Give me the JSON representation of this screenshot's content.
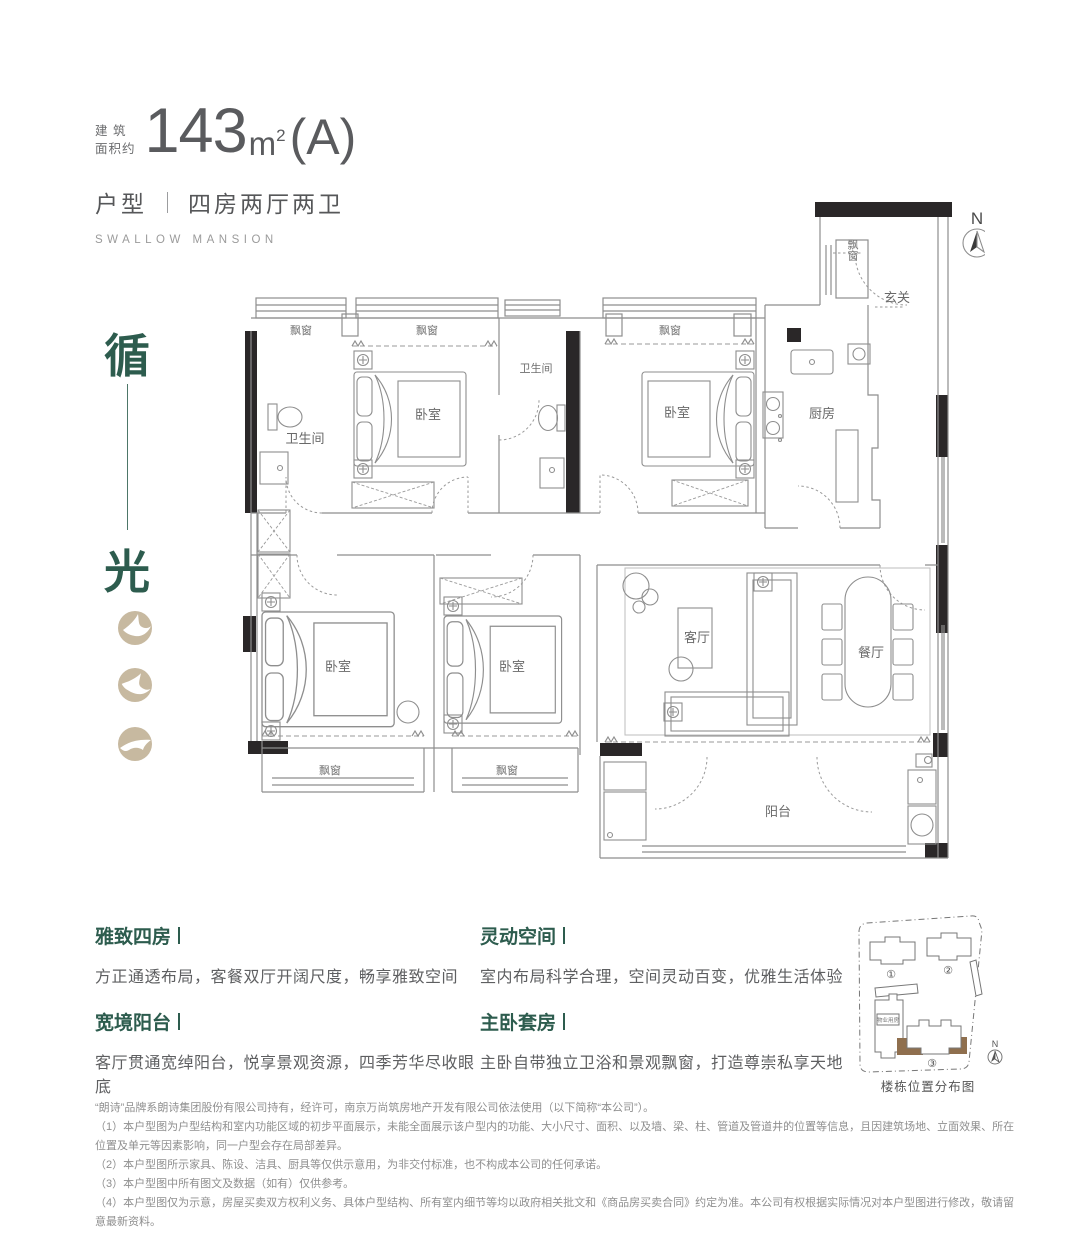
{
  "header": {
    "area_label_line1": "建 筑",
    "area_label_line2": "面积约",
    "area_value": "143",
    "area_unit": "m",
    "area_unit_sup": "2",
    "area_variant": "(A)",
    "type_label": "户型",
    "type_value": "四房两厅两卫",
    "subtitle": "SWALLOW MANSION"
  },
  "side_motto": {
    "top": "循",
    "bottom": "光"
  },
  "compass": {
    "north": "N"
  },
  "floorplan": {
    "rooms": {
      "bay_window": "飘窗",
      "bedroom": "卧室",
      "bathroom": "卫生间",
      "kitchen": "厨房",
      "entry": "玄关",
      "living_room": "客厅",
      "dining_room": "餐厅",
      "balcony": "阳台"
    }
  },
  "features": [
    {
      "title": "雅致四房",
      "desc": "方正通透布局，客餐双厅开阔尺度，畅享雅致空间"
    },
    {
      "title": "宽境阳台",
      "desc": "客厅贯通宽绰阳台，悦享景观资源，四季芳华尽收眼底"
    },
    {
      "title": "灵动空间",
      "desc": "室内布局科学合理，空间灵动百变，优雅生活体验"
    },
    {
      "title": "主卧套房",
      "desc": "主卧自带独立卫浴和景观飘窗，打造尊崇私享天地"
    }
  ],
  "sitemap": {
    "caption": "楼栋位置分布图",
    "buildings": [
      "①",
      "②",
      "③"
    ],
    "property_room_label": "物业用房",
    "north": "N",
    "highlight_color": "#8f6f4e"
  },
  "disclaimer": {
    "lines": [
      "“朗诗”品牌系朗诗集团股份有限公司持有，经许可，南京万尚筑房地产开发有限公司依法使用（以下简称“本公司”）。",
      "（1）本户型图为户型结构和室内功能区域的初步平面展示，未能全面展示该户型内的功能、大小尺寸、面积、以及墙、梁、柱、管道及管道井的位置等信息，且因建筑场地、立面效果、所在位置及单元等因素影响，同一户型会存在局部差异。",
      "（2）本户型图所示家具、陈设、洁具、厨具等仅供示意用，为非交付标准，也不构成本公司的任何承诺。",
      "（3）本户型图中所有图文及数据（如有）仅供参考。",
      "（4）本户型图仅为示意，房屋买卖双方权利义务、具体户型结构、所有室内细节等均以政府相关批文和《商品房买卖合同》约定为准。本公司有权根据实际情况对本户型图进行修改，敬请留意最新资料。"
    ]
  },
  "colors": {
    "accent_green": "#2d5c4e",
    "icon_beige": "#c7b9a0",
    "highlight_brown": "#8f6f4e"
  }
}
